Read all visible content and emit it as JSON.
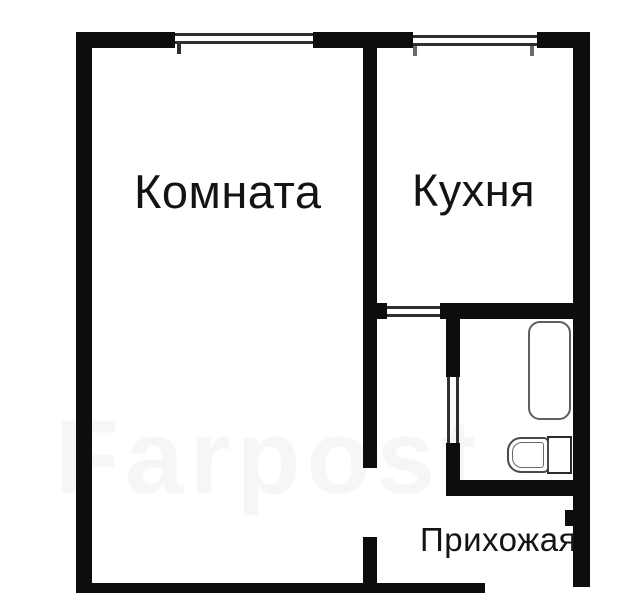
{
  "diagram": {
    "type": "apartment-floor-plan",
    "rooms": [
      {
        "id": "living-room",
        "label": "Комната"
      },
      {
        "id": "kitchen",
        "label": "Кухня"
      },
      {
        "id": "hallway",
        "label": "Прихожая"
      },
      {
        "id": "bathroom",
        "label": ""
      }
    ],
    "fixtures": [
      {
        "id": "bathtub",
        "name": "bathtub"
      },
      {
        "id": "toilet",
        "name": "toilet-with-tank"
      }
    ],
    "openings": {
      "windows": [
        "living-room-window",
        "kitchen-window"
      ],
      "doors": [
        "kitchen-door",
        "bathroom-door",
        "living-room-door-gap",
        "entrance-gap"
      ]
    }
  },
  "colors": {
    "wall": "#0d0d0d",
    "thin_line": "#2f2f2f",
    "fixture_outline": "#4a4a4a",
    "background": "#ffffff"
  },
  "watermark": {
    "text": "Farpost"
  }
}
